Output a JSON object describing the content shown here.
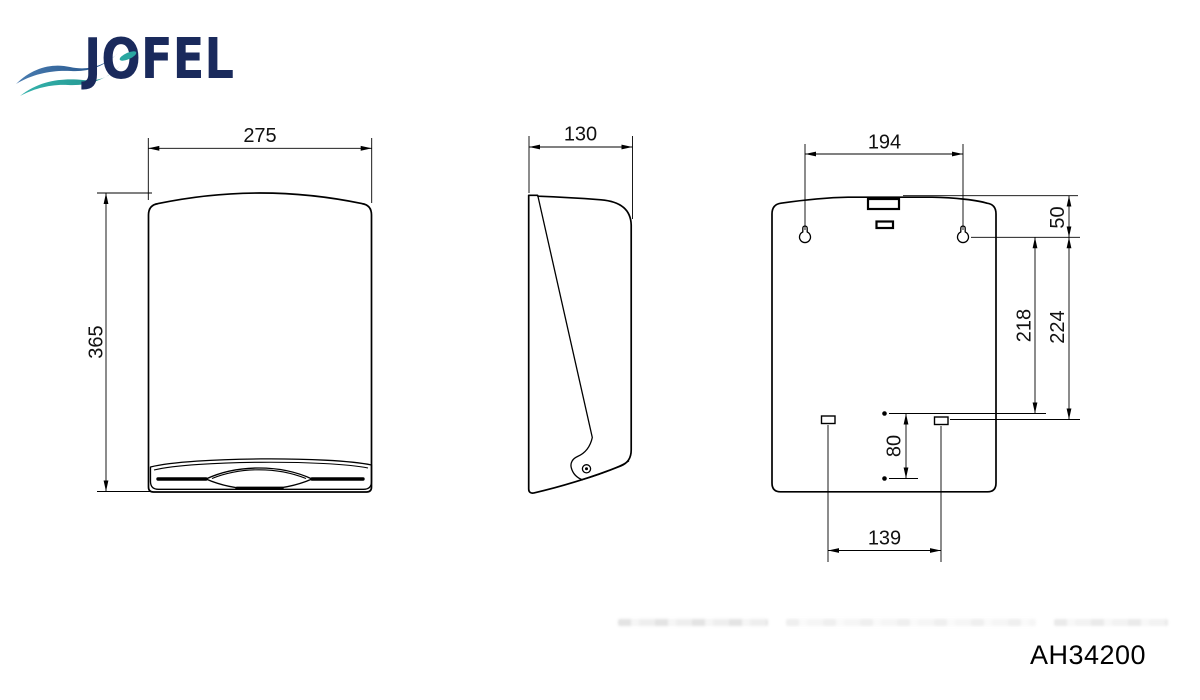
{
  "brand": {
    "name": "JOFEL",
    "colors": {
      "navy": "#1a2a5c",
      "blue": "#3a6da3",
      "teal": "#2aa7a1"
    }
  },
  "drawing": {
    "model_code": "AH34200",
    "views": {
      "front": {
        "name": "front view",
        "width_mm": "275",
        "height_mm": "365"
      },
      "side": {
        "name": "side view",
        "depth_mm": "130"
      },
      "back": {
        "name": "back view",
        "mounting_hole_spacing_mm": "194",
        "top_to_mounting_holes_mm": "50",
        "mounting_holes_to_pin_mm": "218",
        "mounting_holes_to_slot_mm": "224",
        "pin_spacing_mm": "80",
        "slot_spacing_mm": "139"
      }
    }
  }
}
